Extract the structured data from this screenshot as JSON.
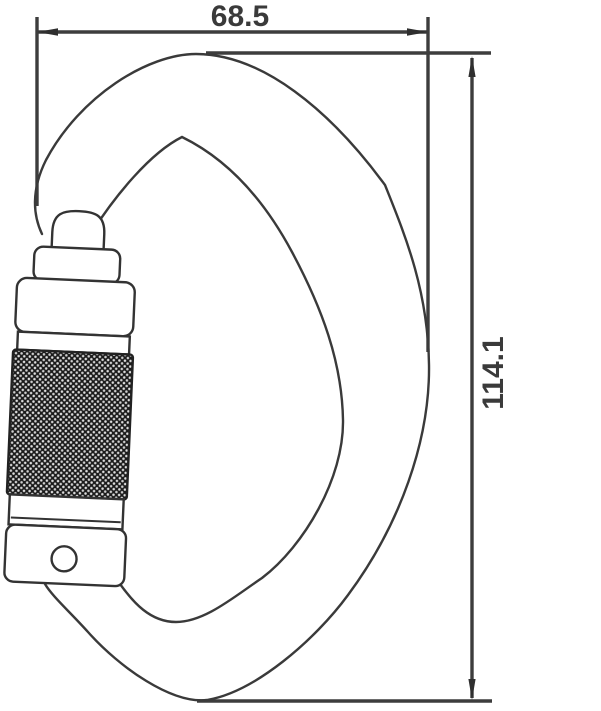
{
  "drawing": {
    "type": "technical-dimension-drawing",
    "subject": "twist-lock carabiner side view",
    "width_dimension": {
      "value": "68.5"
    },
    "height_dimension": {
      "value": "114.1"
    }
  },
  "colors": {
    "background": "#ffffff",
    "dimension_line": "#3d3d3d",
    "dimension_text": "#3a3a3a",
    "outline": "#3a3a3a",
    "knurl_dark": "#1b1b1b",
    "knurl_dot": "#dedede"
  }
}
